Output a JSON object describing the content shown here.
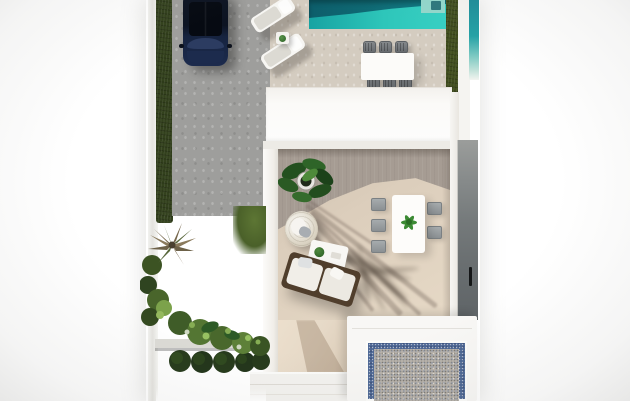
{
  "scene": {
    "description": "Top-down 3D architectural render of a modern villa plot: swimming pool with loungers and dining set, parked car on a driveway, inner courtyard terrace with sofa, egg chair and dining table, dark garden lawn with palm and bushes, and a gravel solarium with blue tile border",
    "objects": [
      "parked-car",
      "swimming-pool",
      "pool-steps",
      "sun-loungers",
      "lounger-side-table",
      "outdoor-dining-set",
      "left-hedge",
      "right-hedge",
      "neighbor-pool",
      "house-roof",
      "courtyard-terrace",
      "potted-plant",
      "hanging-egg-chair",
      "coffee-table",
      "outdoor-sofa",
      "courtyard-dining-set",
      "entry-wall",
      "door-handle",
      "gravel-solarium",
      "garden-lawn",
      "palm-tree",
      "garden-bushes",
      "planter-ledge",
      "trimmed-bushes"
    ]
  },
  "colors": {
    "background": "#ffffff",
    "roof_white": "#fbfaf8",
    "hedge_green": "#33411d",
    "lawn_dark": "#243317",
    "lawn_moss": "#5d7634",
    "driveway_gray": "#9e9e9c",
    "terrace_sand": "#d4ccc0",
    "pool_teal_dark": "#0d5e6b",
    "pool_turquoise": "#2ec6ba",
    "pool_steps": "#93d7cb",
    "neighbor_pool": "#1f8e9a",
    "car_navy": "#16233f",
    "car_roof_black": "#060a12",
    "courtyard_taupe": "#a69c93",
    "courtyard_sunlit": "#e6d9c6",
    "sofa_frame_brown": "#503e2c",
    "cushion_white": "#f1eee8",
    "chair_gray": "#8b9093",
    "dark_wall_gray": "#757a7b",
    "solarium_blue": "#4d6794",
    "gravel_gray": "#b6b1aa",
    "plant_green": "#3c8a33"
  }
}
